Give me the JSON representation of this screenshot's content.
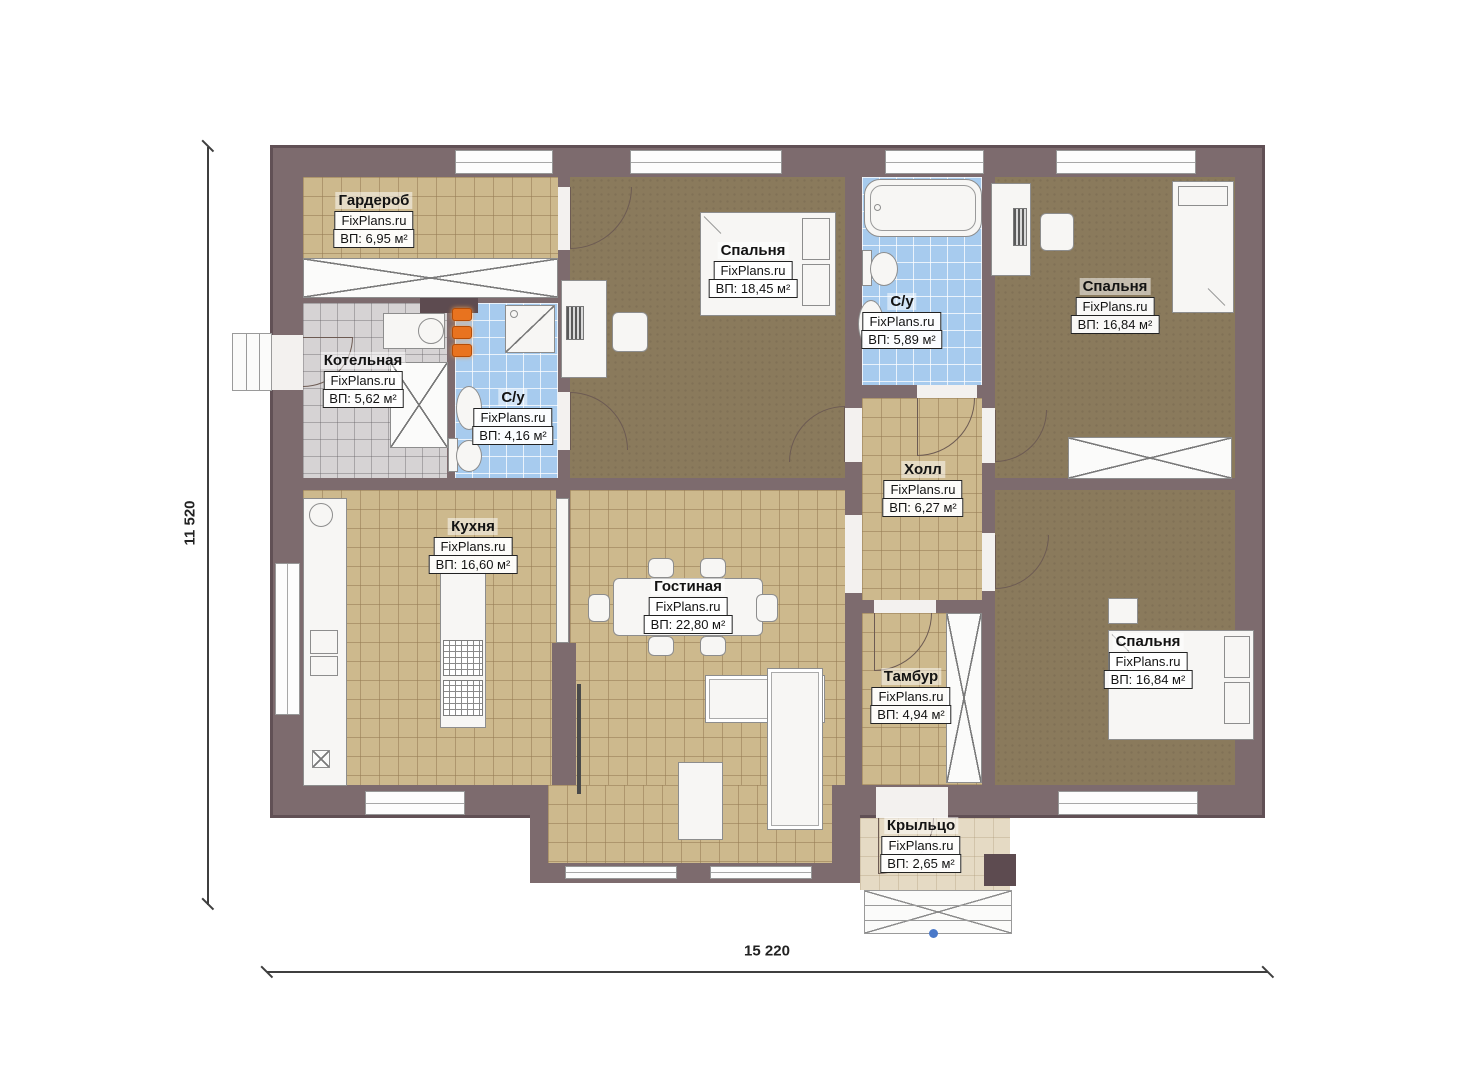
{
  "brand": "FixPlans.ru",
  "dimensions": {
    "height": "11 520",
    "width": "15 220"
  },
  "rooms": [
    {
      "key": "wardrobe",
      "name": "Гардероб",
      "area": "ВП: 6,95 м²"
    },
    {
      "key": "boiler",
      "name": "Котельная",
      "area": "ВП: 5,62 м²"
    },
    {
      "key": "bath-small",
      "name": "С/у",
      "area": "ВП: 4,16 м²"
    },
    {
      "key": "bedroom-1",
      "name": "Спальня",
      "area": "ВП: 18,45 м²"
    },
    {
      "key": "bath-main",
      "name": "С/у",
      "area": "ВП: 5,89 м²"
    },
    {
      "key": "bedroom-2",
      "name": "Спальня",
      "area": "ВП: 16,84 м²"
    },
    {
      "key": "hall",
      "name": "Холл",
      "area": "ВП: 6,27 м²"
    },
    {
      "key": "kitchen",
      "name": "Кухня",
      "area": "ВП: 16,60 м²"
    },
    {
      "key": "living",
      "name": "Гостиная",
      "area": "ВП: 22,80 м²"
    },
    {
      "key": "vestibule",
      "name": "Тамбур",
      "area": "ВП: 4,94 м²"
    },
    {
      "key": "bedroom-3",
      "name": "Спальня",
      "area": "ВП: 16,84 м²"
    },
    {
      "key": "porch",
      "name": "Крыльцо",
      "area": "ВП: 2,65 м²"
    }
  ],
  "colors": {
    "wall": "#7d6b6e",
    "tan_floor": "#cdb98d",
    "brown_floor": "#8a7a5c",
    "blue_floor": "#a7cbee",
    "gray_floor": "#d6d3d4",
    "porch_floor": "#e5dac4",
    "burner_accent": "#e8731f"
  }
}
